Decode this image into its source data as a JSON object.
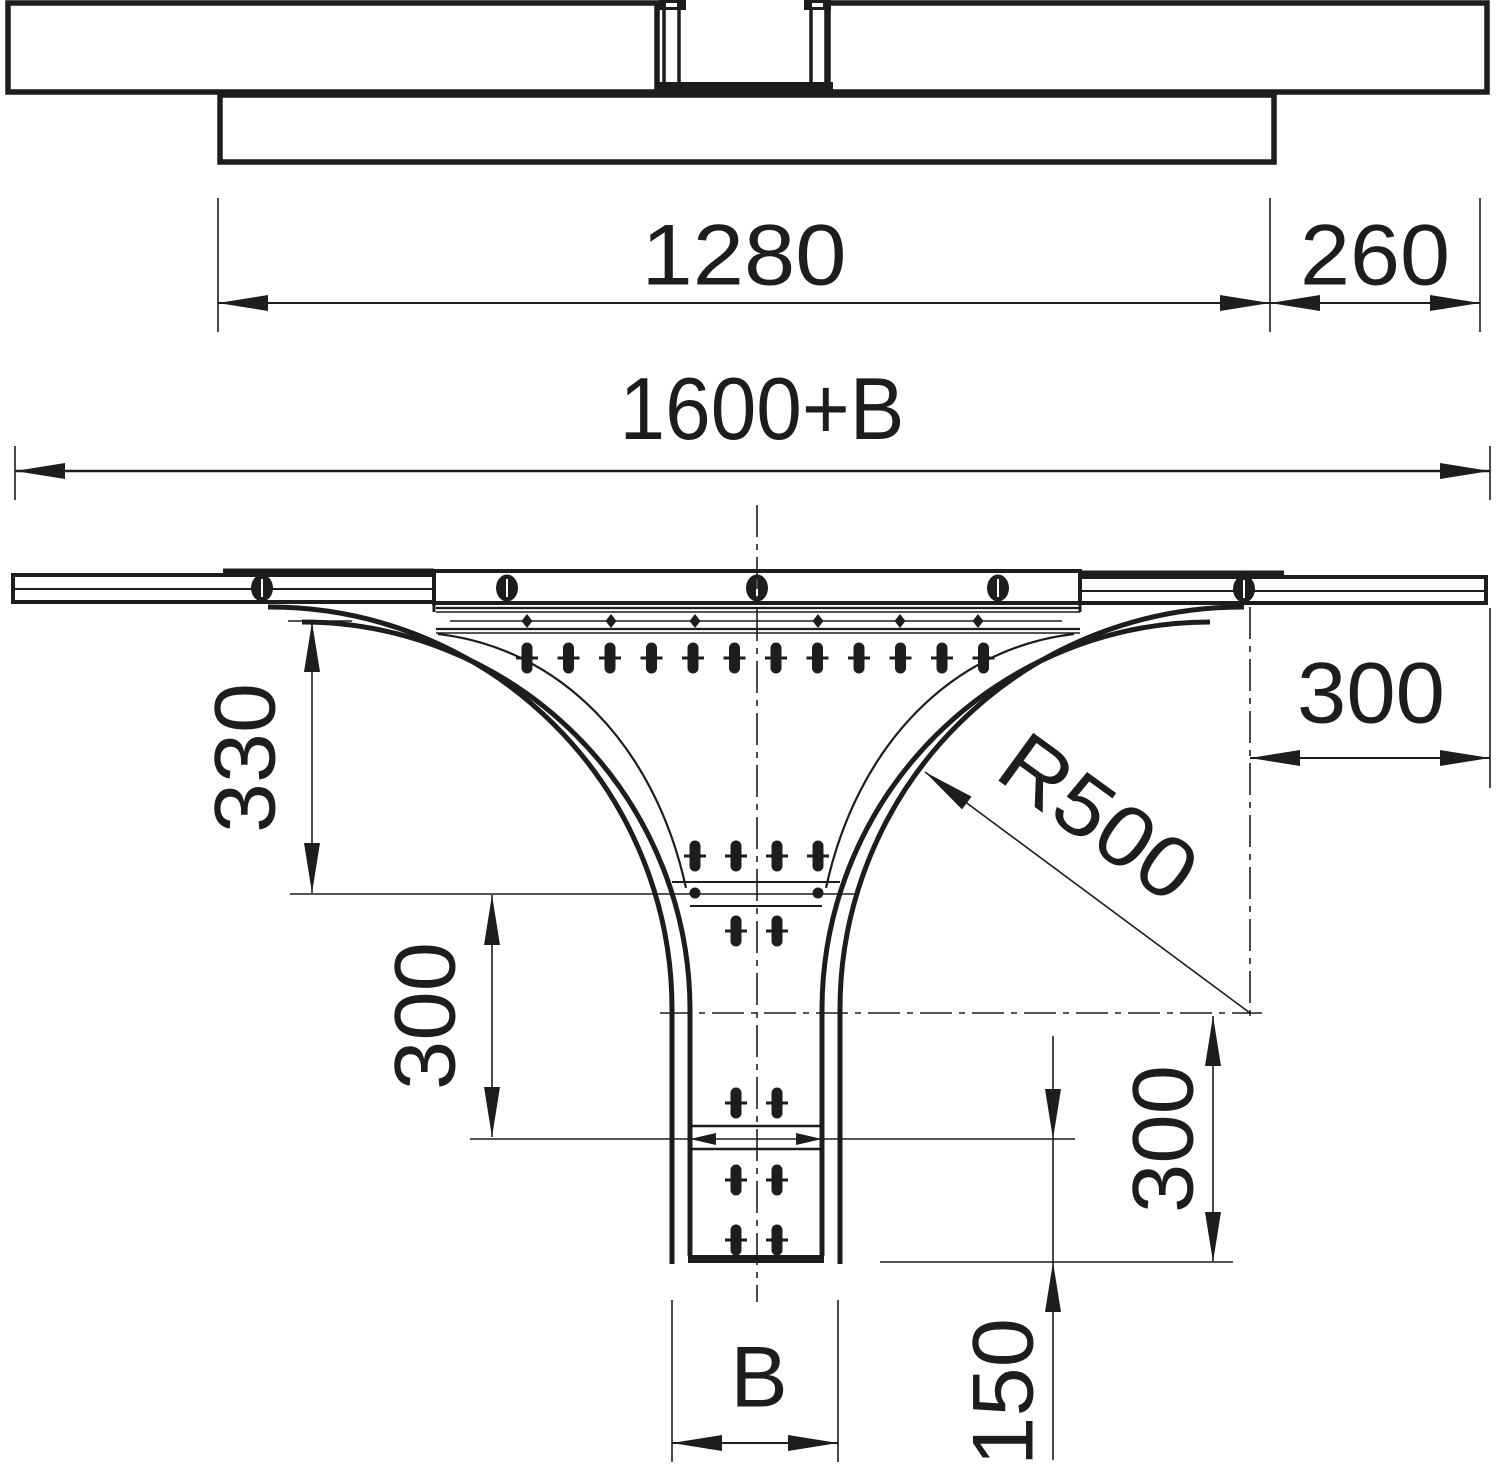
{
  "title": "Cable tray add-on tee — dimensional drawing",
  "colors": {
    "line": "#1d1d1b",
    "background": "#ffffff"
  },
  "top_view": {
    "dim_piece_length": "1280",
    "dim_overhang_right": "260"
  },
  "main_view": {
    "dim_overall_width": "1600+B",
    "dim_flare_height": "330",
    "dim_left_lower": "300",
    "dim_radius": "R500",
    "dim_overhang_right": "300",
    "dim_trunk_lower": "300",
    "dim_trunk_end": "150",
    "dim_branch_width": "B"
  }
}
